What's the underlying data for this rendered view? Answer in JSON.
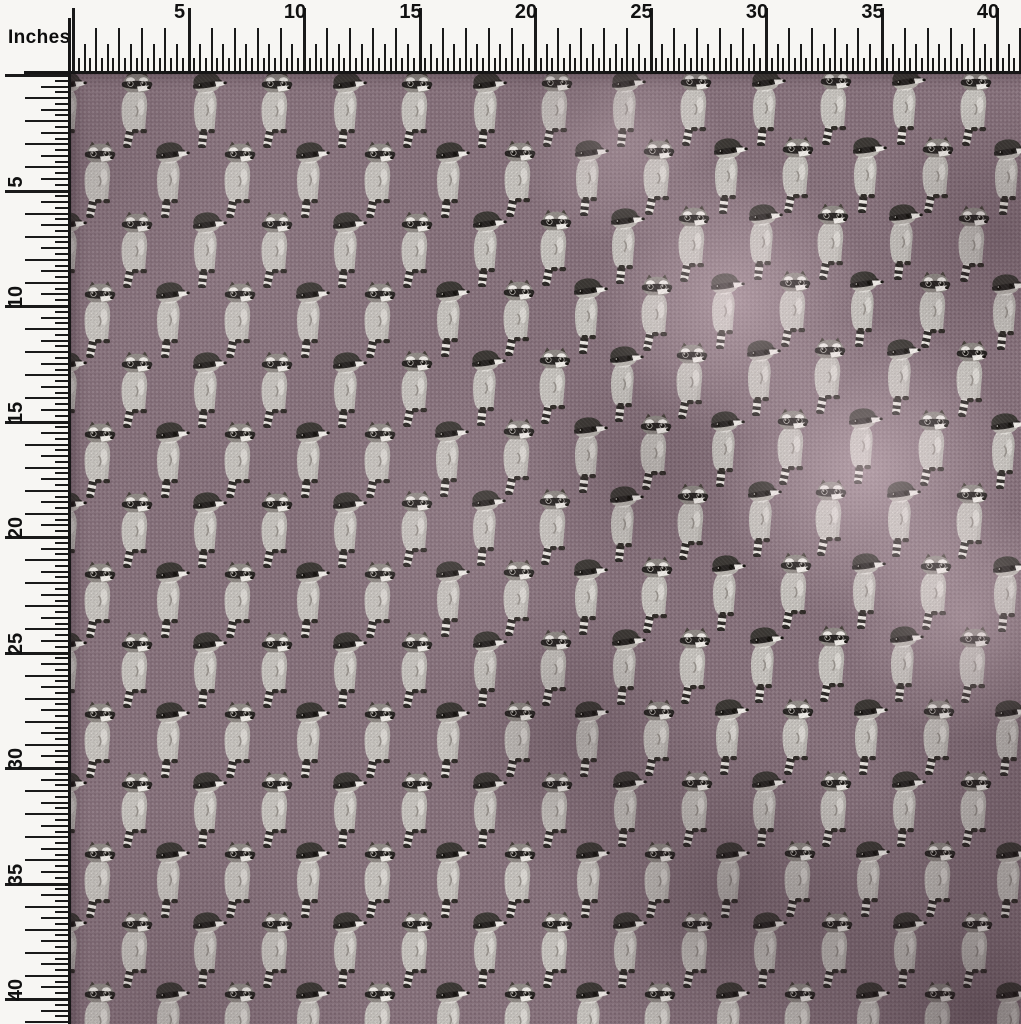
{
  "rulers": {
    "unit_label": "Inches",
    "numbers": [
      5,
      10,
      15,
      20,
      25,
      30,
      35,
      40
    ],
    "px_per_inch": 23.1,
    "origin_x": 72,
    "origin_y": 74,
    "length_in": 41,
    "background": "#F7F6F3",
    "tick_color": "#1A1A1A",
    "number_color": "#111111"
  },
  "fabric": {
    "description": "mauve cotton swatch with raccoon block print, soft fold on right side",
    "base_color": "#85707A",
    "weave_light": "#93828B",
    "weave_dark": "#6F5D66",
    "fold_highlight": "#B49CA4",
    "fold_shadow": "#4E3C44",
    "motif_name": "raccoon",
    "motif_types": [
      "eared-hunched-raccoon",
      "capped-head-up-raccoon"
    ],
    "grid": {
      "row_y0": 108,
      "row_step": 70,
      "col_step": 70,
      "even_row_x0": 137,
      "odd_row_x0": 100,
      "rows": 14,
      "col_min": -1,
      "col_max": 13,
      "motif_w": 44,
      "motif_h": 78
    }
  },
  "raccoon": {
    "body": "#C6C3BE",
    "body_shade": "#ADA9A4",
    "head": "#8E8984",
    "cap": "#3A3733",
    "cap_brim": "#2C2925",
    "mask": "#252220",
    "white": "#EEEBE6",
    "tail_dark": "#2A2724",
    "tail_light": "#E9E6E0",
    "feet": "#2E2A26",
    "ear": "#454039",
    "eye": "#14120E",
    "glint": "#DCD8D2"
  }
}
